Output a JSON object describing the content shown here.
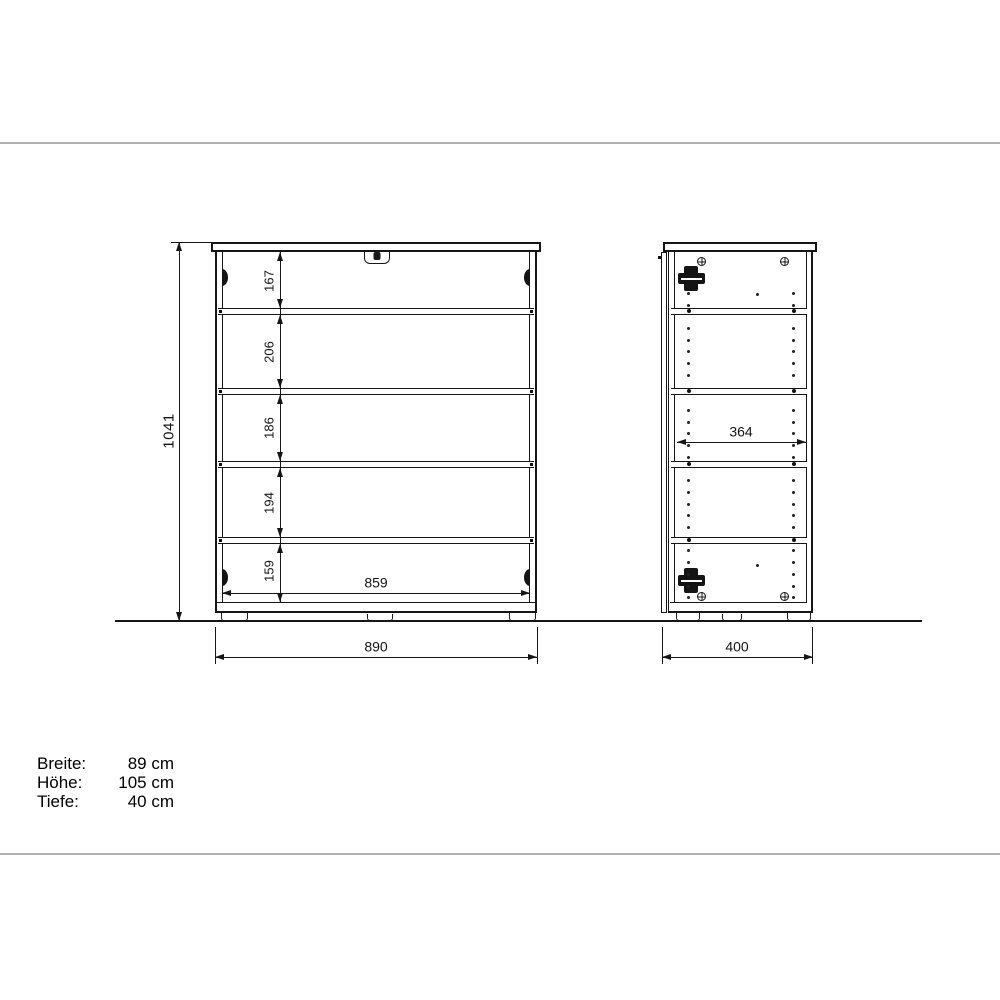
{
  "drawing": {
    "front_view": {
      "overall_height_label": "1041",
      "shelf_spacing_labels": [
        "167",
        "206",
        "186",
        "194",
        "159"
      ],
      "inner_width_label": "859",
      "overall_width_label": "890"
    },
    "side_view": {
      "inner_depth_label": "364",
      "overall_depth_label": "400"
    }
  },
  "specs": {
    "rows": [
      {
        "label": "Breite:",
        "value": "89 cm"
      },
      {
        "label": "Höhe:",
        "value": "105 cm"
      },
      {
        "label": "Tiefe:",
        "value": "40 cm"
      }
    ]
  },
  "colors": {
    "drawing_line": "#161616",
    "separator_line": "#b2b2b2",
    "background": "#ffffff"
  }
}
